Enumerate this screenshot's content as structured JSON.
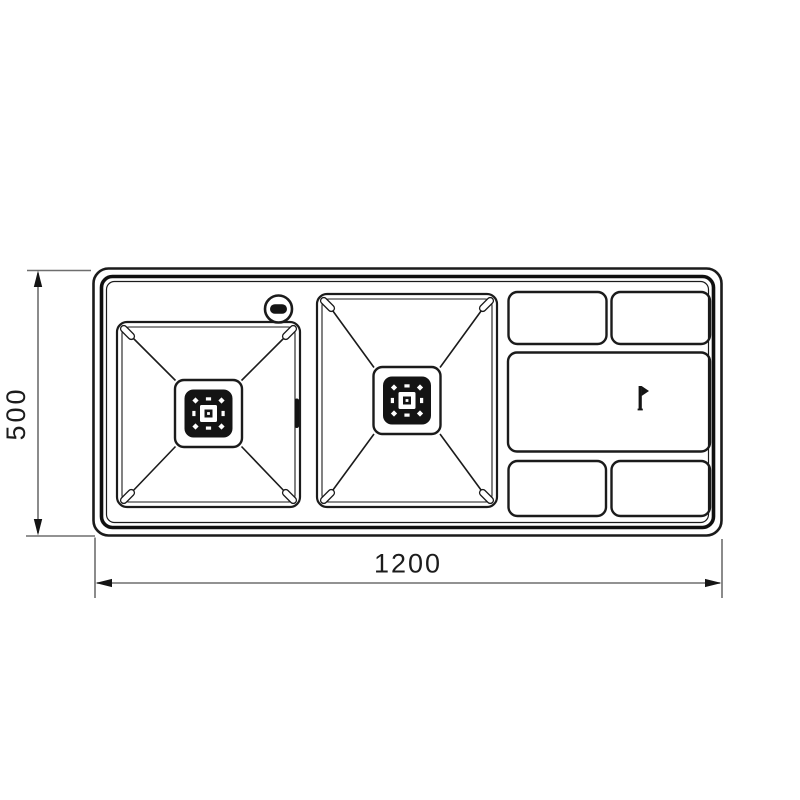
{
  "page": {
    "background": "#ffffff"
  },
  "drawing": {
    "type": "technical-drawing",
    "subject": "double-bowl-kitchen-sink-top-view",
    "colors": {
      "outline": "#1b1b1b",
      "rim": "#101010",
      "detail_fill": "#141414",
      "dimension_line": "#6e6e6e",
      "dimension_arrow": "#141414",
      "dimension_text": "#1c1c1c"
    },
    "dimensions": {
      "width_label": "1200",
      "height_label": "500"
    },
    "components": {
      "left_bowl": "square-bowl-with-drain",
      "right_bowl": "square-bowl-with-drain",
      "tap_hole": "knob-circle-icon",
      "overflow": "overflow-slot",
      "drainer_panel_count": 5,
      "brand_mark": "flag-icon"
    }
  }
}
